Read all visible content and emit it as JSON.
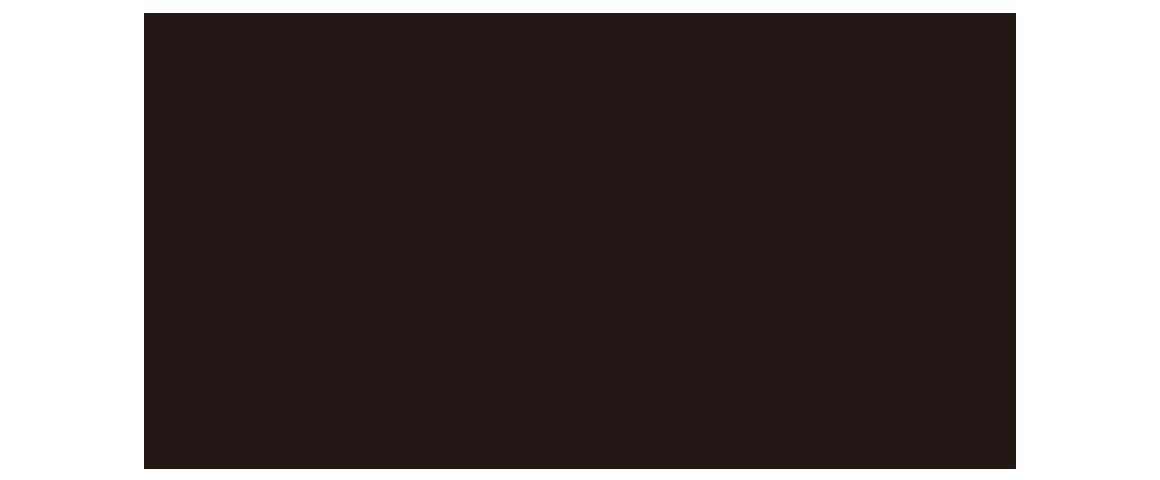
{
  "colors": {
    "page_background": "#ffffff",
    "panel_background": "#231815"
  }
}
